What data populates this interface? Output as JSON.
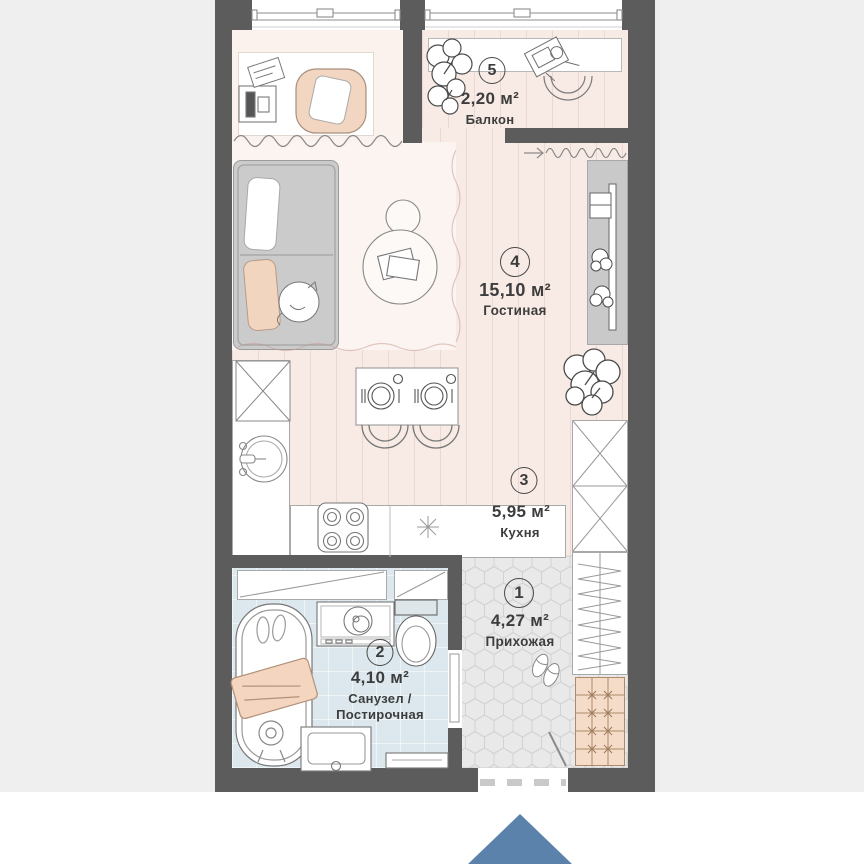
{
  "colors": {
    "bg": "#efefef",
    "wall": "#5c5c5c",
    "floor-main": "#f8ebe6",
    "floor-rug": "#fcf4f0",
    "floor-hall": "#e9e9e9",
    "floor-bath": "#dce8ee",
    "sofa-gray": "#cbcbcb",
    "console-gray": "#c9c9c9",
    "shoe-tile": "#f5dcc9",
    "accent-peach": "#f2d5bf",
    "logo-blue": "#5b82aa",
    "text": "#3d3d3d"
  },
  "rooms": [
    {
      "number": "1",
      "area": "4,27 м²",
      "name": "Прихожая"
    },
    {
      "number": "2",
      "area": "4,10 м²",
      "name": "Санузел /",
      "name2": "Постирочная"
    },
    {
      "number": "3",
      "area": "5,95 м²",
      "name": "Кухня"
    },
    {
      "number": "4",
      "area": "15,10 м²",
      "name": "Гостиная"
    },
    {
      "number": "5",
      "area": "2,20 м²",
      "name": "Балкон"
    }
  ]
}
